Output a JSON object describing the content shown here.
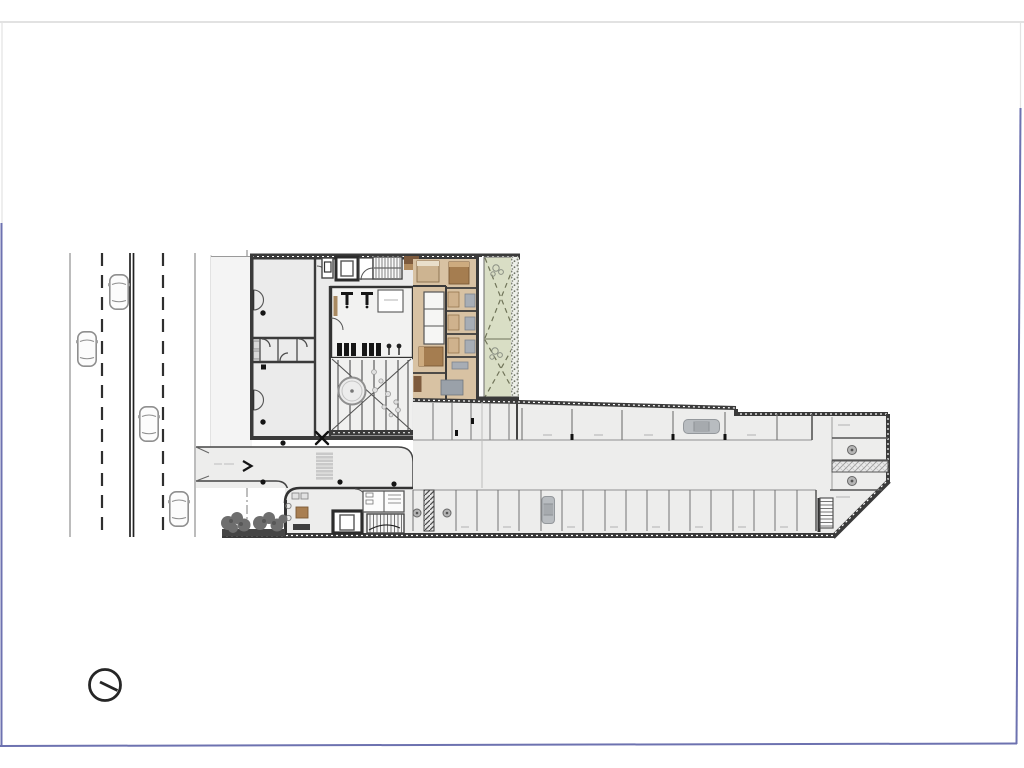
{
  "document": {
    "type": "architectural-floor-plan-scan",
    "description": "Ground floor plan: street with traffic at left, residential block with gym, patio and garden apartments, entry driveway, lobby and long parking garage wing; north indicator at bottom left",
    "readable_text": "",
    "note": "all drawing annotations are below legibility at this resolution"
  },
  "colors": {
    "frame_blue": "#6d72b0",
    "frame_gray": "#d9d9d9",
    "wall": "#3a3a3a",
    "ink": "#161616",
    "floor": "#ebebeb",
    "terrace": "#f4f4f4",
    "line": "#8f8f8f",
    "stall": "#737373",
    "tan": "#d8c2a3",
    "bed_brown": "#a57d50",
    "bed_light": "#cdb491",
    "wood_dark": "#7d5a3d",
    "wood": "#b08a5e",
    "furn": "#a7adb5",
    "green": "#d9dec5",
    "green_line": "#6f7358",
    "hedge": "#7b8073",
    "car": "#b8bcc0",
    "tree": "#6e6e6e",
    "ramp": "#c9c9c9"
  },
  "street": {
    "lane_lines": [
      "solid",
      "dashed",
      "double-solid",
      "dashed",
      "solid-kerb"
    ],
    "moving_cars": 4
  },
  "site": {
    "property_line_style": "dash-dot",
    "garden_panels": 2,
    "tree_canopies": 7
  },
  "building": {
    "zones": [
      "left-rooms",
      "wc-block",
      "elevator-core",
      "stair",
      "gym",
      "patio-pergola",
      "apartments",
      "garden",
      "driveway",
      "lobby",
      "parking-garage"
    ],
    "gym_benches": 6,
    "patio_feature": "round-spa-with-pergola-lines",
    "column_dots": 7,
    "x_joint_markers": 2
  },
  "parking": {
    "upper_row_stalls": 6,
    "storage_lockers": 5,
    "lower_row_stalls": 19,
    "parked_cars": 2,
    "round_columns": 4,
    "hatched_ramp_bands": 2,
    "service_stair": 1
  },
  "symbols": {
    "north_indicator": "circle-with-needle"
  }
}
